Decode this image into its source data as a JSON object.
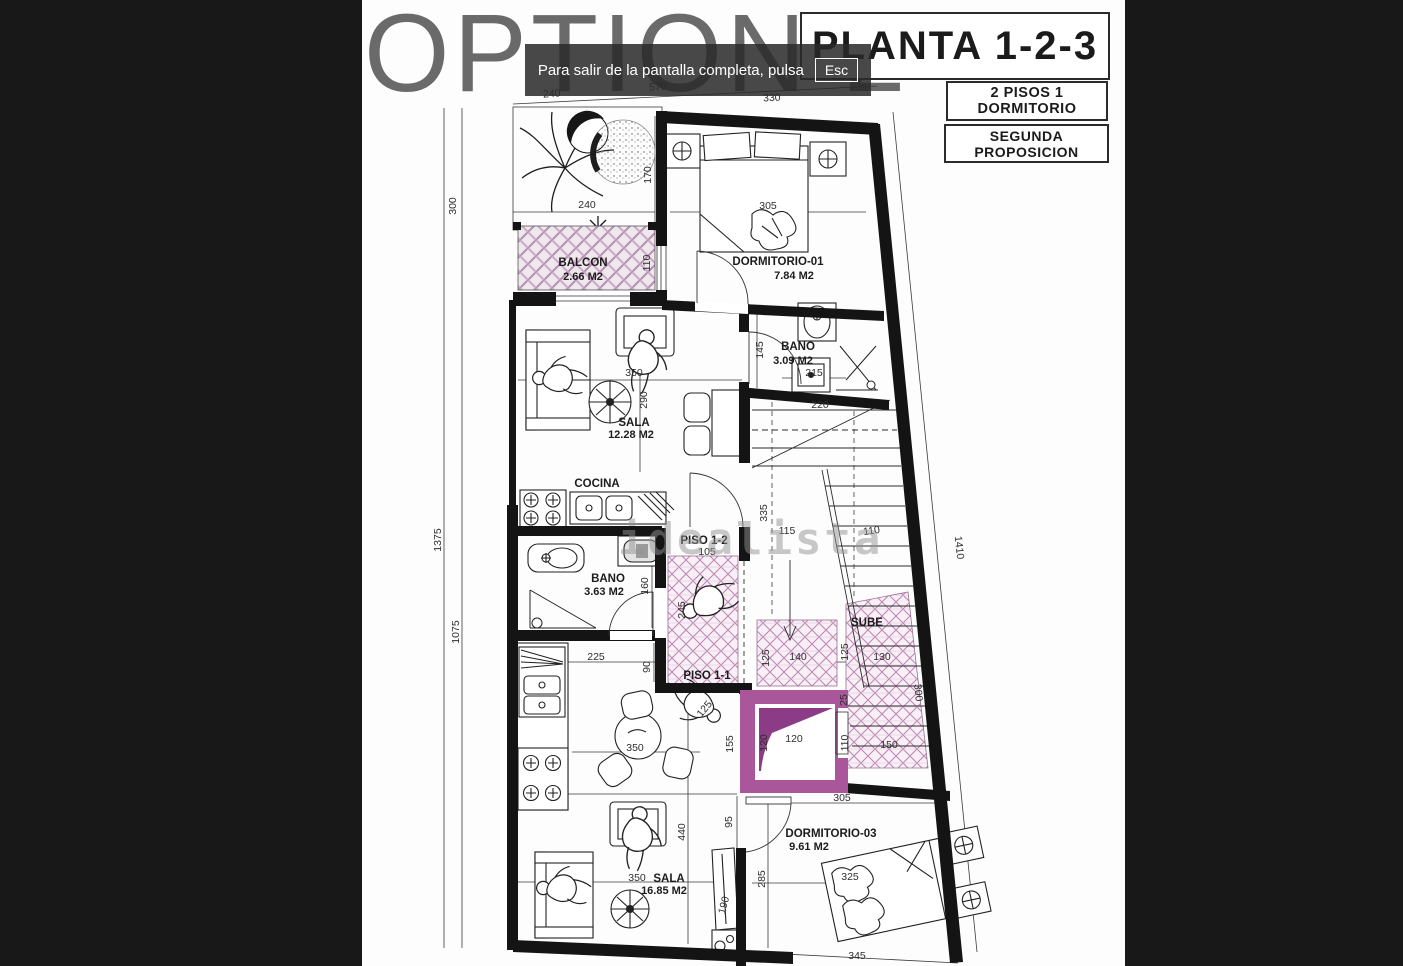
{
  "overlay": {
    "message": "Para salir de la pantalla completa, pulsa",
    "esc": "Esc"
  },
  "header": {
    "title": "OPTION 2",
    "plan": "PLANTA 1-2-3",
    "tag1": "2 PISOS 1 DORMITORIO",
    "tag2": "SEGUNDA PROPOSICION"
  },
  "watermark": "idealista",
  "rooms": [
    {
      "name": "BALCON",
      "area": "2.66 M2"
    },
    {
      "name": "DORMITORIO-01",
      "area": "7.84 M2"
    },
    {
      "name": "BANO",
      "area": "3.09 M2"
    },
    {
      "name": "SALA",
      "area": "12.28 M2"
    },
    {
      "name": "COCINA",
      "area": ""
    },
    {
      "name": "BANO",
      "area": "3.63 M2"
    },
    {
      "name": "PISO 1-2",
      "area": ""
    },
    {
      "name": "PISO 1-1",
      "area": ""
    },
    {
      "name": "SUBE",
      "area": ""
    },
    {
      "name": "DORMITORIO-03",
      "area": "9.61 M2"
    },
    {
      "name": "SALA",
      "area": "16.85 M2"
    }
  ],
  "dims": [
    {
      "v": "240"
    },
    {
      "v": "570"
    },
    {
      "v": "330"
    },
    {
      "v": "300"
    },
    {
      "v": "1375"
    },
    {
      "v": "1075"
    },
    {
      "v": "1410"
    },
    {
      "v": "170"
    },
    {
      "v": "240"
    },
    {
      "v": "110"
    },
    {
      "v": "305"
    },
    {
      "v": "145"
    },
    {
      "v": "215"
    },
    {
      "v": "350"
    },
    {
      "v": "290"
    },
    {
      "v": "220"
    },
    {
      "v": "335"
    },
    {
      "v": "115"
    },
    {
      "v": "110"
    },
    {
      "v": "105"
    },
    {
      "v": "245"
    },
    {
      "v": "160"
    },
    {
      "v": "225"
    },
    {
      "v": "90"
    },
    {
      "v": "125"
    },
    {
      "v": "140"
    },
    {
      "v": "125"
    },
    {
      "v": "130"
    },
    {
      "v": "25"
    },
    {
      "v": "300"
    },
    {
      "v": "110"
    },
    {
      "v": "150"
    },
    {
      "v": "120"
    },
    {
      "v": "120"
    },
    {
      "v": "305"
    },
    {
      "v": "155"
    },
    {
      "v": "125"
    },
    {
      "v": "285"
    },
    {
      "v": "325"
    },
    {
      "v": "345"
    },
    {
      "v": "350"
    },
    {
      "v": "350"
    },
    {
      "v": "440"
    },
    {
      "v": "95"
    },
    {
      "v": "190"
    }
  ],
  "colors": {
    "elevator": "#a9569b",
    "elevator_dark": "#8c3c86",
    "hatch_line": "#bd84b4",
    "title_gray": "#6a6a6a",
    "toast_bg": "rgba(42,42,42,0.86)"
  }
}
